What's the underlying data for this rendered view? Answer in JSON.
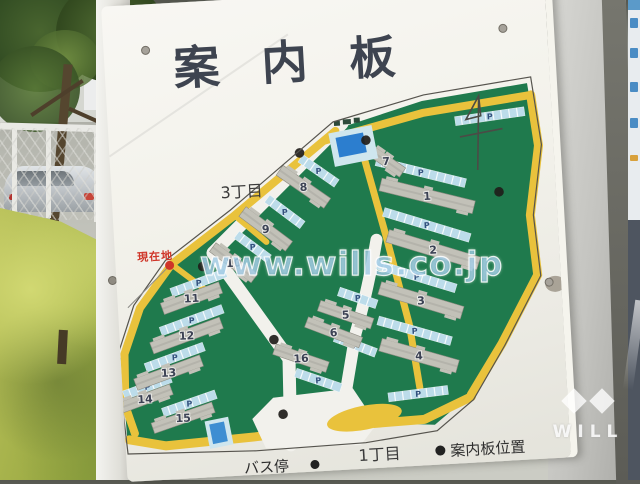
{
  "title": {
    "text": "案内板",
    "chars": [
      "案",
      "内",
      "板"
    ]
  },
  "labels": {
    "district_top": "3丁目",
    "district_bottom": "1丁目",
    "current_location": "現在地",
    "bus_stop": "バス停",
    "board_position_legend": "案内板位置"
  },
  "watermark": {
    "url": "www.wills.co.jp",
    "brand": "WILL"
  },
  "map": {
    "parking_label": "P",
    "colors": {
      "green": "#1f7a4d",
      "road_yellow": "#e9c23c",
      "parking_blue": "#bcdcea",
      "building_gray": "#c2c1b8",
      "pool_blue": "#2c7ecf",
      "facility_blue": "#3e8ed2",
      "outline": "#56544e",
      "current_red": "#cf3528",
      "marker_black": "#1f1d1a",
      "number_color": "#3c4254"
    },
    "buildings": [
      {
        "n": "1",
        "x": 315,
        "y": 207,
        "l": 96,
        "w": 13,
        "a": 17
      },
      {
        "n": "2",
        "x": 318,
        "y": 261,
        "l": 95,
        "w": 13,
        "a": 20
      },
      {
        "n": "3",
        "x": 303,
        "y": 311,
        "l": 86,
        "w": 13,
        "a": 20
      },
      {
        "n": "4",
        "x": 298,
        "y": 366,
        "l": 80,
        "w": 13,
        "a": 19
      },
      {
        "n": "5",
        "x": 227,
        "y": 321,
        "l": 56,
        "w": 11,
        "a": 22
      },
      {
        "n": "6",
        "x": 214,
        "y": 338,
        "l": 58,
        "w": 11,
        "a": 24
      },
      {
        "n": "7",
        "x": 276,
        "y": 170,
        "l": 40,
        "w": 11,
        "a": 38
      },
      {
        "n": "8",
        "x": 192,
        "y": 191,
        "l": 58,
        "w": 12,
        "a": 38
      },
      {
        "n": "9",
        "x": 152,
        "y": 231,
        "l": 58,
        "w": 12,
        "a": 40
      },
      {
        "n": "10",
        "x": 118,
        "y": 263,
        "l": 52,
        "w": 11,
        "a": 40
      },
      {
        "n": "11",
        "x": 74,
        "y": 296,
        "l": 62,
        "w": 12,
        "a": -17
      },
      {
        "n": "12",
        "x": 67,
        "y": 333,
        "l": 74,
        "w": 12,
        "a": -17
      },
      {
        "n": "13",
        "x": 47,
        "y": 369,
        "l": 70,
        "w": 12,
        "a": -17
      },
      {
        "n": "14",
        "x": 22,
        "y": 394,
        "l": 56,
        "w": 11,
        "a": -17
      },
      {
        "n": "15",
        "x": 59,
        "y": 415,
        "l": 64,
        "w": 11,
        "a": -16
      },
      {
        "n": "16",
        "x": 180,
        "y": 362,
        "l": 56,
        "w": 11,
        "a": 22
      }
    ],
    "parkings": [
      {
        "x": 310,
        "y": 183,
        "l": 92,
        "a": 17
      },
      {
        "x": 313,
        "y": 236,
        "l": 90,
        "a": 20
      },
      {
        "x": 300,
        "y": 287,
        "l": 82,
        "a": 20
      },
      {
        "x": 295,
        "y": 341,
        "l": 76,
        "a": 19
      },
      {
        "x": 240,
        "y": 305,
        "l": 40,
        "a": 22
      },
      {
        "x": 235,
        "y": 352,
        "l": 44,
        "a": 24
      },
      {
        "x": 196,
        "y": 385,
        "l": 48,
        "a": 22
      },
      {
        "x": 262,
        "y": 158,
        "l": 40,
        "a": 38
      },
      {
        "x": 208,
        "y": 176,
        "l": 44,
        "a": 38
      },
      {
        "x": 172,
        "y": 215,
        "l": 44,
        "a": 40
      },
      {
        "x": 138,
        "y": 248,
        "l": 40,
        "a": 40
      },
      {
        "x": 82,
        "y": 281,
        "l": 58,
        "a": -17
      },
      {
        "x": 73,
        "y": 318,
        "l": 66,
        "a": -17
      },
      {
        "x": 54,
        "y": 354,
        "l": 62,
        "a": -17
      },
      {
        "x": 25,
        "y": 382,
        "l": 50,
        "a": -17
      },
      {
        "x": 66,
        "y": 401,
        "l": 56,
        "a": -16
      },
      {
        "x": 382,
        "y": 131,
        "l": 70,
        "a": -5
      },
      {
        "x": 295,
        "y": 404,
        "l": 60,
        "a": -4
      }
    ],
    "board_markers": [
      [
        190,
        157
      ],
      [
        257,
        148
      ],
      [
        387,
        207
      ],
      [
        87,
        265
      ],
      [
        154,
        342
      ],
      [
        159,
        417
      ]
    ]
  }
}
